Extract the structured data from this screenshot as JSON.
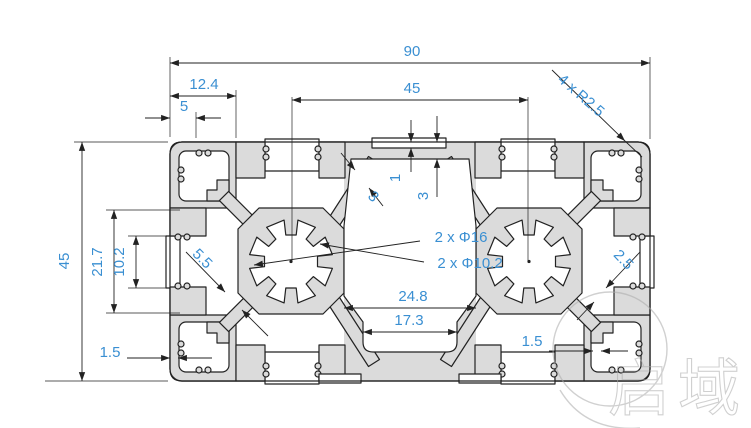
{
  "drawing": {
    "type": "aluminum-extrusion-profile-cross-section",
    "dimensions": {
      "overall_width": "90",
      "overall_height": "45",
      "bore_center_distance": "45",
      "corner_block_width": "12.4",
      "edge_tab_width": "5",
      "corner_radius": "4 x R2.5",
      "face_step_depth": "1",
      "top_wall_thickness": "3",
      "web_thickness_top": "3",
      "core_bore_outer": "2 x Φ16",
      "core_bore_inner": "2 x Φ10.2",
      "web_thickness_center": "5.5",
      "slot_chamber_height": "21.7",
      "slot_opening": "10.2",
      "channel_width": "24.8",
      "channel_opening": "17.3",
      "wall_thickness_left": "1.5",
      "wall_thickness_right": "1.5",
      "web_thickness_corner": "2.5"
    },
    "watermark": {
      "text": "启域"
    },
    "colors": {
      "dimension_text": "#3a8fd2",
      "profile_fill": "#dbdbdb",
      "line": "#222222",
      "watermark": "#aaaaaa"
    }
  }
}
